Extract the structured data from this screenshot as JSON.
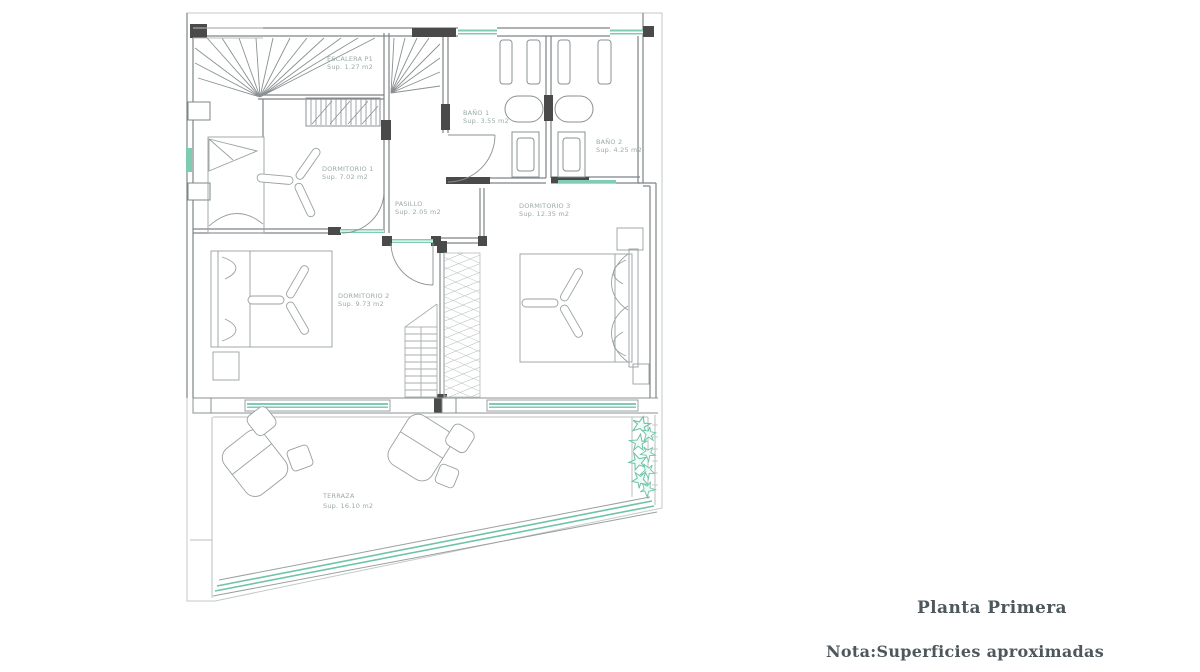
{
  "footer": {
    "title": "Planta Primera",
    "note": "Nota:Superficies aproximadas"
  },
  "plan": {
    "rooms": [
      {
        "id": "escalera",
        "name": "ESCALERA P1",
        "area": "Sup. 1.27 m2"
      },
      {
        "id": "bano1",
        "name": "BAÑO 1",
        "area": "Sup. 3.55 m2"
      },
      {
        "id": "bano2",
        "name": "BAÑO 2",
        "area": "Sup. 4.25 m2"
      },
      {
        "id": "dormitorio1",
        "name": "DORMITORIO 1",
        "area": "Sup. 7.02 m2"
      },
      {
        "id": "pasillo",
        "name": "PASILLO",
        "area": "Sup. 2.05 m2"
      },
      {
        "id": "dormitorio3",
        "name": "DORMITORIO 3",
        "area": "Sup. 12.35 m2"
      },
      {
        "id": "dormitorio2",
        "name": "DORMITORIO 2",
        "area": "Sup. 9.73 m2"
      },
      {
        "id": "terraza",
        "name": "TERRAZA",
        "area": "Sup. 16.10 m2"
      }
    ],
    "colors": {
      "accent_teal": "#6fc3a8",
      "accent_teal_light": "#bfe7da",
      "line_gray": "#8a9192",
      "light_gray": "#b9bfbe",
      "wall_dark": "#4a4a4a",
      "label_gray": "#9aaba5",
      "text_dark": "#4e585c",
      "background": "#ffffff"
    }
  }
}
